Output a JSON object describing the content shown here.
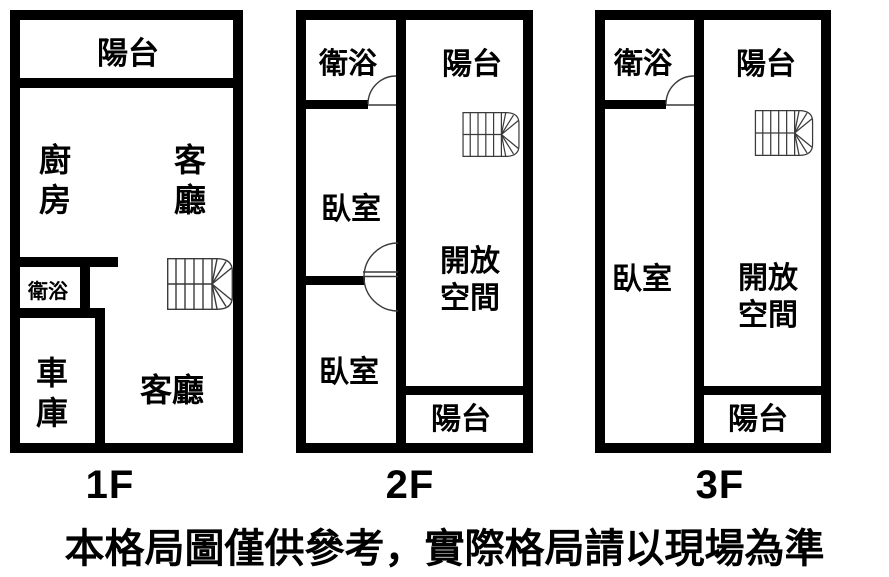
{
  "disclaimer": "本格局圖僅供參考，實際格局請以現場為準",
  "colors": {
    "wall": "#000000",
    "background": "#ffffff",
    "thin_line": "#3a3a3a"
  },
  "floors": [
    {
      "name": "1F",
      "rooms": {
        "balcony_top": "陽台",
        "kitchen": "廚房",
        "living_upper": "客廳",
        "bathroom": "衛浴",
        "garage": "車庫",
        "living_lower": "客廳"
      }
    },
    {
      "name": "2F",
      "rooms": {
        "bathroom": "衛浴",
        "balcony_top": "陽台",
        "bedroom_upper": "臥室",
        "open_space": "開放空間",
        "bedroom_lower": "臥室",
        "balcony_bottom": "陽台"
      }
    },
    {
      "name": "3F",
      "rooms": {
        "bathroom": "衛浴",
        "balcony_top": "陽台",
        "bedroom": "臥室",
        "open_space": "開放空間",
        "balcony_bottom": "陽台"
      }
    }
  ]
}
